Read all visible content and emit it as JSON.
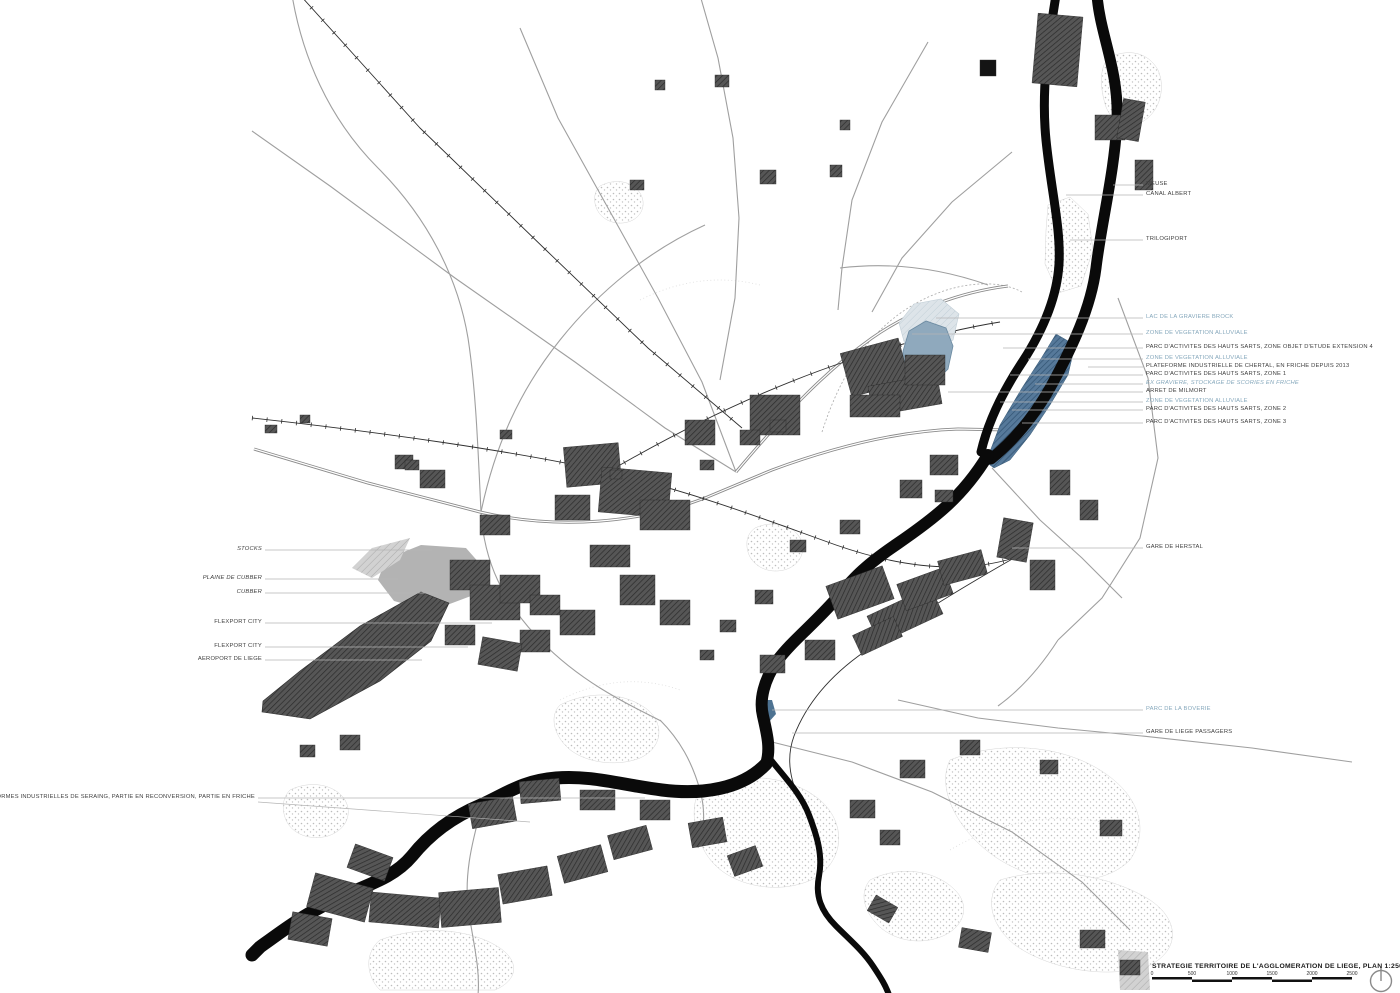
{
  "map": {
    "title": "STRATEGIE TERRITOIRE DE L'AGGLOMERATION DE LIEGE, PLAN 1:25000",
    "scale_bar": {
      "tick_labels": [
        "0",
        "500",
        "1000",
        "1500",
        "2000",
        "2500"
      ],
      "segments": 5
    },
    "north_indicator": "north-arrow-circle"
  },
  "colors": {
    "label_black": "#3f3f3f",
    "label_blue": "#86a8bc",
    "leader_line": "#b5b5b5",
    "river_black": "#0a0a0a",
    "zone_blue": "#4e7392",
    "lake_blue": "#8fa9bd",
    "pale_alluvial_blue": "#dbe3e8",
    "urban_dark": "#474747",
    "gray_zone": "#b3b3b3"
  },
  "labels": [
    {
      "text": "MEUSE",
      "x": 1146,
      "y": 185,
      "side": "right",
      "color": "black",
      "italic": false,
      "to": 1113
    },
    {
      "text": "CANAL ALBERT",
      "x": 1146,
      "y": 195,
      "side": "right",
      "color": "black",
      "italic": false,
      "to": 1066
    },
    {
      "text": "TRILOGIPORT",
      "x": 1146,
      "y": 240,
      "side": "right",
      "color": "black",
      "italic": false,
      "to": 1070
    },
    {
      "text": "LAC DE LA GRAVIERE BROCK",
      "x": 1146,
      "y": 318,
      "side": "right",
      "color": "blue",
      "italic": false,
      "to": 936
    },
    {
      "text": "ZONE DE VEGETATION ALLUVIALE",
      "x": 1146,
      "y": 334,
      "side": "right",
      "color": "blue",
      "italic": false,
      "to": 912
    },
    {
      "text": "PARC D'ACTIVITES DES HAUTS SARTS, ZONE OBJET D'ETUDE EXTENSION 4",
      "x": 1146,
      "y": 348,
      "side": "right",
      "color": "black",
      "italic": false,
      "to": 1003
    },
    {
      "text": "ZONE DE VEGETATION ALLUVIALE",
      "x": 1146,
      "y": 359,
      "side": "right",
      "color": "blue",
      "italic": false,
      "to": 1028
    },
    {
      "text": "PLATEFORME INDUSTRIELLE DE CHERTAL, EN FRICHE DEPUIS 2013",
      "x": 1146,
      "y": 367,
      "side": "right",
      "color": "black",
      "italic": false,
      "to": 1088
    },
    {
      "text": "PARC D'ACTIVITES DES HAUTS SARTS, ZONE 1",
      "x": 1146,
      "y": 375,
      "side": "right",
      "color": "black",
      "italic": false,
      "to": 1010
    },
    {
      "text": "EX GRAVIERE, STOCKAGE DE SCORIES EN FRICHE",
      "x": 1146,
      "y": 384,
      "side": "right",
      "color": "blue",
      "italic": true,
      "to": 1035
    },
    {
      "text": "ARRET DE MILMORT",
      "x": 1146,
      "y": 392,
      "side": "right",
      "color": "black",
      "italic": false,
      "to": 948
    },
    {
      "text": "ZONE DE VEGETATION ALLUVIALE",
      "x": 1146,
      "y": 402,
      "side": "right",
      "color": "blue",
      "italic": false,
      "to": 1000
    },
    {
      "text": "PARC D'ACTIVITES DES HAUTS SARTS, ZONE 2",
      "x": 1146,
      "y": 410,
      "side": "right",
      "color": "black",
      "italic": false,
      "to": 1012
    },
    {
      "text": "PARC D'ACTIVITES DES HAUTS SARTS, ZONE 3",
      "x": 1146,
      "y": 423,
      "side": "right",
      "color": "black",
      "italic": false,
      "to": 1022
    },
    {
      "text": "GARE DE HERSTAL",
      "x": 1146,
      "y": 548,
      "side": "right",
      "color": "black",
      "italic": false,
      "to": 1012
    },
    {
      "text": "PARC DE LA BOVERIE",
      "x": 1146,
      "y": 710,
      "side": "right",
      "color": "blue",
      "italic": false,
      "to": 772
    },
    {
      "text": "GARE DE LIEGE PASSAGERS",
      "x": 1146,
      "y": 733,
      "side": "right",
      "color": "black",
      "italic": false,
      "to": 792
    },
    {
      "text": "STOCKS",
      "x": 262,
      "y": 550,
      "side": "left",
      "color": "black",
      "italic": true,
      "to": 432
    },
    {
      "text": "PLAINE DE CUBBER",
      "x": 262,
      "y": 579,
      "side": "left",
      "color": "black",
      "italic": true,
      "to": 398
    },
    {
      "text": "CUBBER",
      "x": 262,
      "y": 593,
      "side": "left",
      "color": "black",
      "italic": true,
      "to": 438
    },
    {
      "text": "FLEXPORT CITY",
      "x": 262,
      "y": 623,
      "side": "left",
      "color": "black",
      "italic": false,
      "to": 492
    },
    {
      "text": "FLEXPORT CITY",
      "x": 262,
      "y": 647,
      "side": "left",
      "color": "black",
      "italic": false,
      "to": 468
    },
    {
      "text": "AEROPORT DE LIEGE",
      "x": 262,
      "y": 660,
      "side": "left",
      "color": "black",
      "italic": false,
      "to": 422
    },
    {
      "text": "PLATEFORMES INDUSTRIELLES DE SERAING, PARTIE EN RECONVERSION, PARTIE EN FRICHE",
      "x": 255,
      "y": 798,
      "side": "left",
      "color": "black",
      "italic": false,
      "to": 645
    }
  ],
  "extra_leaders": [
    {
      "x1": 258,
      "y1": 802,
      "x2": 530,
      "y2": 822
    }
  ]
}
